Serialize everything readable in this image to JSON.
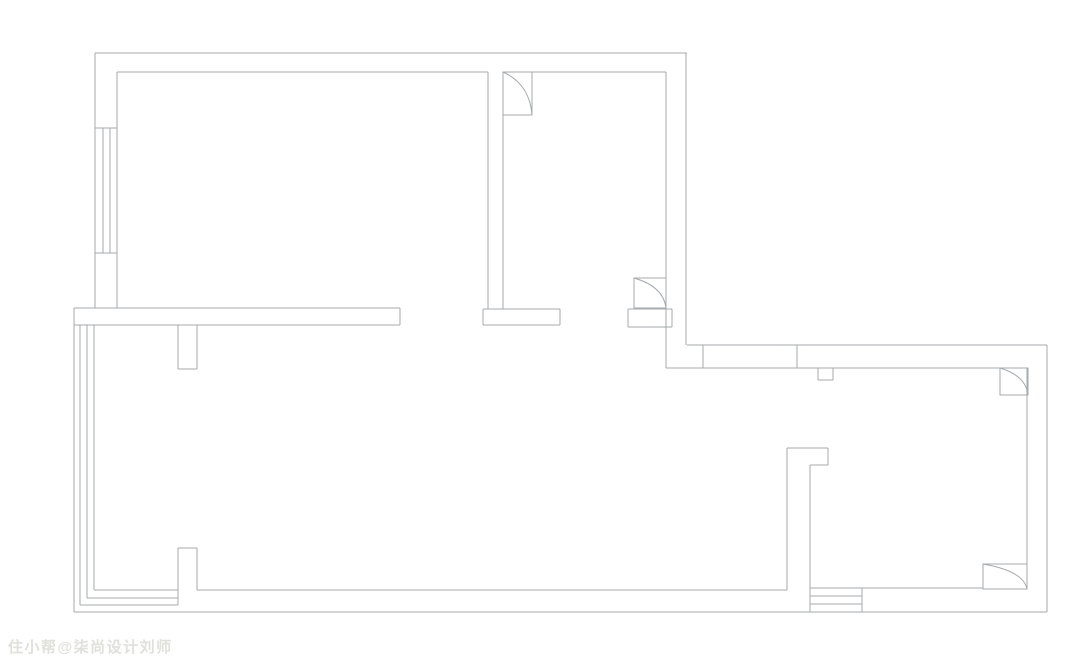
{
  "page": {
    "width": 1080,
    "height": 669,
    "background_color": "#ffffff"
  },
  "watermark": {
    "text": "住小帮@柒尚设计刘师",
    "color": "#e0e0dc"
  },
  "floorplan": {
    "stroke_color": "#a5aaae",
    "stroke_width": 1,
    "segments": [
      [
        95,
        53,
        687,
        53
      ],
      [
        95,
        53,
        95,
        308
      ],
      [
        117,
        72,
        117,
        308
      ],
      [
        117,
        72,
        488,
        72
      ],
      [
        503,
        72,
        666,
        72
      ],
      [
        488,
        72,
        488,
        309
      ],
      [
        503,
        72,
        503,
        309
      ],
      [
        666,
        72,
        666,
        368
      ],
      [
        686,
        53,
        686,
        345
      ],
      [
        95,
        128,
        117,
        128
      ],
      [
        95,
        253,
        117,
        253
      ],
      [
        103,
        128,
        103,
        253
      ],
      [
        110,
        128,
        110,
        253
      ],
      [
        74,
        308,
        400,
        308
      ],
      [
        74,
        325,
        400,
        325
      ],
      [
        400,
        308,
        400,
        325
      ],
      [
        483,
        309,
        560,
        309
      ],
      [
        483,
        325,
        560,
        325
      ],
      [
        483,
        309,
        483,
        325
      ],
      [
        560,
        309,
        560,
        325
      ],
      [
        628,
        309,
        672,
        309
      ],
      [
        628,
        327,
        672,
        327
      ],
      [
        628,
        309,
        628,
        327
      ],
      [
        672,
        309,
        672,
        327
      ],
      [
        74,
        308,
        74,
        612
      ],
      [
        80,
        325,
        80,
        605
      ],
      [
        87,
        325,
        87,
        598
      ],
      [
        94,
        325,
        94,
        590
      ],
      [
        74,
        612,
        1047,
        612
      ],
      [
        80,
        605,
        178,
        605
      ],
      [
        87,
        598,
        178,
        598
      ],
      [
        94,
        590,
        178,
        590
      ],
      [
        197,
        590,
        787,
        590
      ],
      [
        178,
        325,
        178,
        369
      ],
      [
        197,
        325,
        197,
        369
      ],
      [
        178,
        369,
        197,
        369
      ],
      [
        178,
        548,
        197,
        548
      ],
      [
        178,
        548,
        178,
        605
      ],
      [
        197,
        548,
        197,
        590
      ],
      [
        787,
        448,
        828,
        448
      ],
      [
        828,
        448,
        828,
        465
      ],
      [
        810,
        465,
        828,
        465
      ],
      [
        787,
        448,
        787,
        590
      ],
      [
        810,
        465,
        810,
        612
      ],
      [
        687,
        345,
        1047,
        345
      ],
      [
        666,
        368,
        1027,
        368
      ],
      [
        703,
        345,
        703,
        368
      ],
      [
        797,
        345,
        797,
        368
      ],
      [
        818,
        368,
        818,
        380
      ],
      [
        833,
        368,
        833,
        380
      ],
      [
        818,
        380,
        833,
        380
      ],
      [
        1047,
        345,
        1047,
        612
      ],
      [
        1027,
        368,
        1027,
        589
      ],
      [
        810,
        588,
        983,
        588
      ],
      [
        810,
        596,
        862,
        596
      ],
      [
        810,
        604,
        862,
        604
      ],
      [
        862,
        588,
        862,
        612
      ]
    ],
    "door_symbols": [
      {
        "x": 503,
        "y": 72,
        "w": 29,
        "h": 43
      },
      {
        "x": 634,
        "y": 278,
        "w": 32,
        "h": 30
      },
      {
        "x": 1000,
        "y": 368,
        "w": 28,
        "h": 27
      },
      {
        "x": 983,
        "y": 564,
        "w": 44,
        "h": 25
      }
    ]
  }
}
